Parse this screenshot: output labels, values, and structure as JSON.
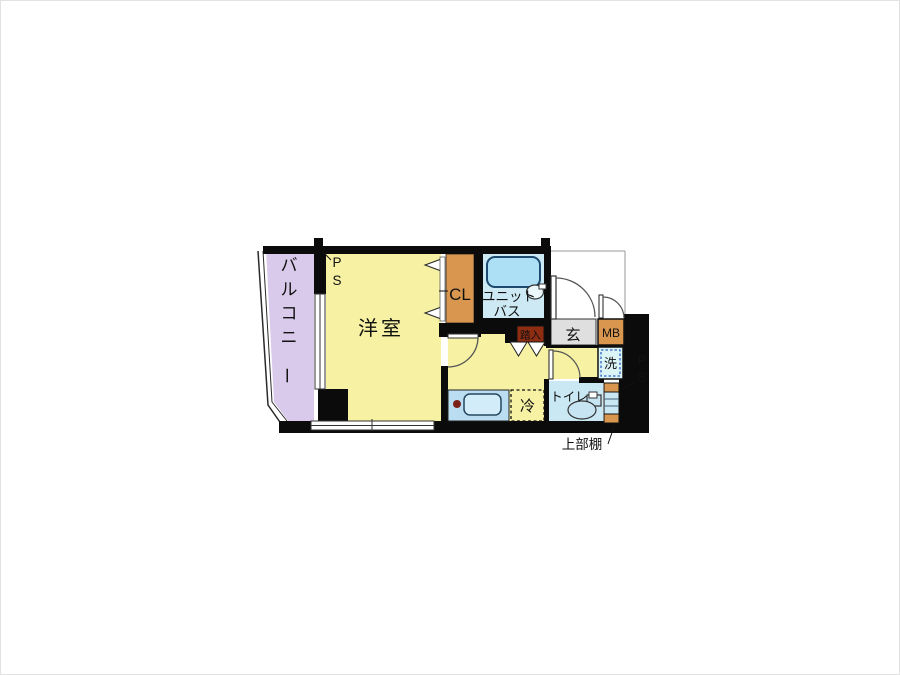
{
  "floorplan": {
    "labels": {
      "balcony": "バルコニー",
      "western_room": "洋室",
      "closet": "CL",
      "unit_bath_line1": "ユニット",
      "unit_bath_line2": "バス",
      "step_in": "踏入",
      "entrance": "玄",
      "meter_box": "MB",
      "washer": "洗",
      "toilet": "トイレ",
      "refrigerator": "冷",
      "upper_shelf": "上部棚",
      "pipe_space_top_left": "PS",
      "pipe_space_right": "PS"
    },
    "colors": {
      "wall": "#0b0b0b",
      "room_yellow": "#F6F1A3",
      "balcony_lavender": "#D9CAEB",
      "closet_orange": "#D9964F",
      "bath_floor_blue": "#CDEAF4",
      "tub_blue": "#ADE0F4",
      "counter_blue": "#BADDF2",
      "sink_blue": "#D2ECFA",
      "toilet_room_blue": "#CAE8F4",
      "fixture_blue": "#C6E4F2",
      "entrance_gray": "#DFDFDF",
      "washer_bg": "#DBF4F6",
      "washer_border": "#2F62C8",
      "step_in_bg": "#8F2D13",
      "step_in_text": "#FFE9C2",
      "burner_red": "#7B2117"
    }
  }
}
